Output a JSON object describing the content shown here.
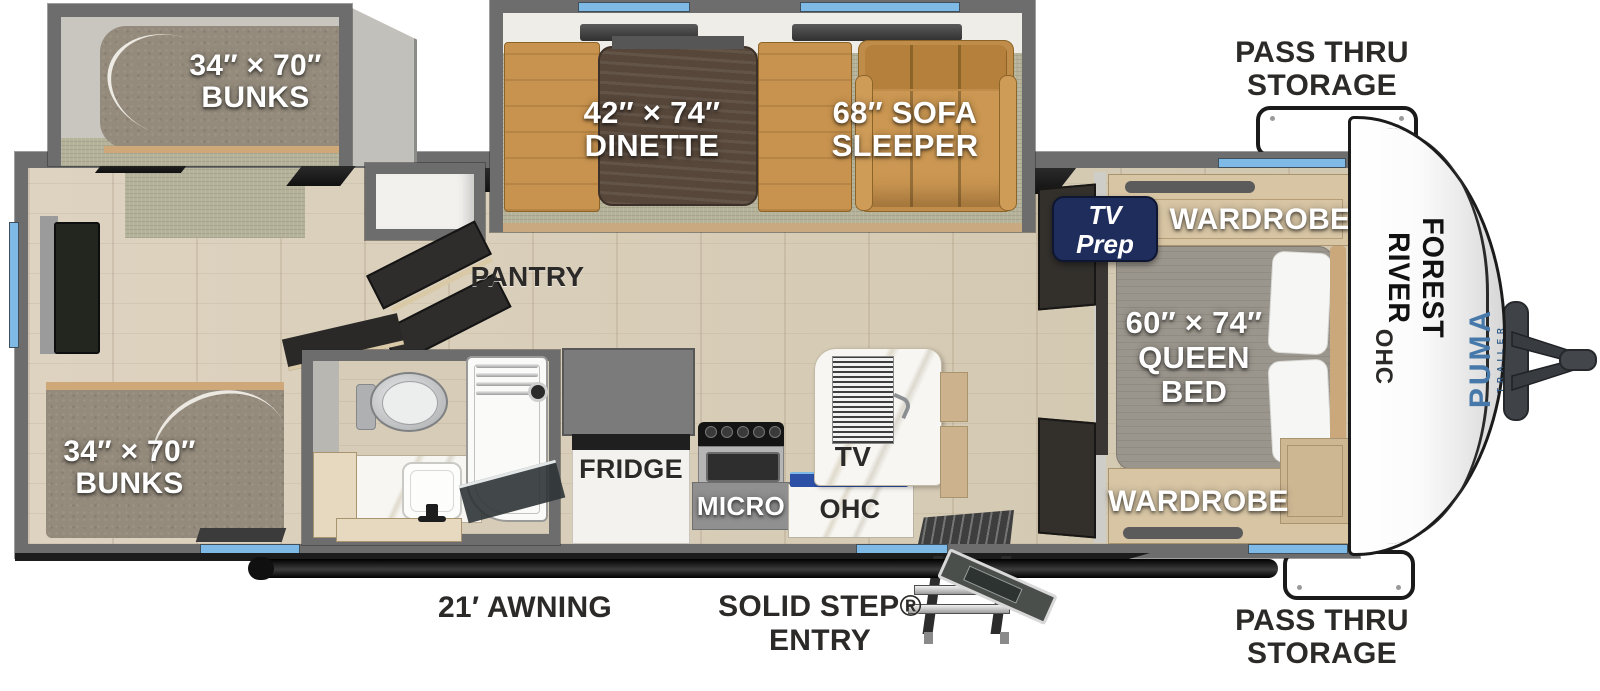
{
  "labels": {
    "bunks_top": {
      "l1": "34″ × 70″",
      "l2": "BUNKS"
    },
    "bunks_bottom": {
      "l1": "34″ × 70″",
      "l2": "BUNKS"
    },
    "dinette": {
      "l1": "42″ × 74″",
      "l2": "DINETTE"
    },
    "sofa": {
      "l1": "68″ SOFA",
      "l2": "SLEEPER"
    },
    "queen_bed": {
      "l1": "60″ × 74″",
      "l2": "QUEEN",
      "l3": "BED"
    },
    "wardrobe_top": "WARDROBE",
    "wardrobe_bottom": "WARDROBE",
    "tv_prep": {
      "l1": "TV",
      "l2": "Prep"
    },
    "ohc_bedroom": "OHC",
    "pantry": "PANTRY",
    "fridge": "FRIDGE",
    "micro": "MICRO",
    "ohc_kitchen": "OHC",
    "tv_kitchen": "TV",
    "pass_thru_top": {
      "l1": "PASS THRU",
      "l2": "STORAGE"
    },
    "pass_thru_bottom": {
      "l1": "PASS THRU",
      "l2": "STORAGE"
    },
    "awning": "21′ AWNING",
    "entry": {
      "l1": "SOLID STEP®",
      "l2": "ENTRY"
    }
  },
  "brand": {
    "manufacturer": "FOREST RIVER",
    "model": "PUMA",
    "model_sub": "TRAILER"
  },
  "colors": {
    "wall": "#6d6d6d",
    "window_blue": "#7fb9e6",
    "floor_wood": "#d9cfbc",
    "carpet": "#b5b29a",
    "sofa_tan": "#c8934e",
    "mattress_gray": "#948b7c",
    "cabinet_tan": "#d7c5a4",
    "tv_prep_navy": "#1f2d5d",
    "ohc_bar_blue": "#2d50a7",
    "puma_blue": "#4679a9",
    "label_dark": "#2b2a28"
  }
}
